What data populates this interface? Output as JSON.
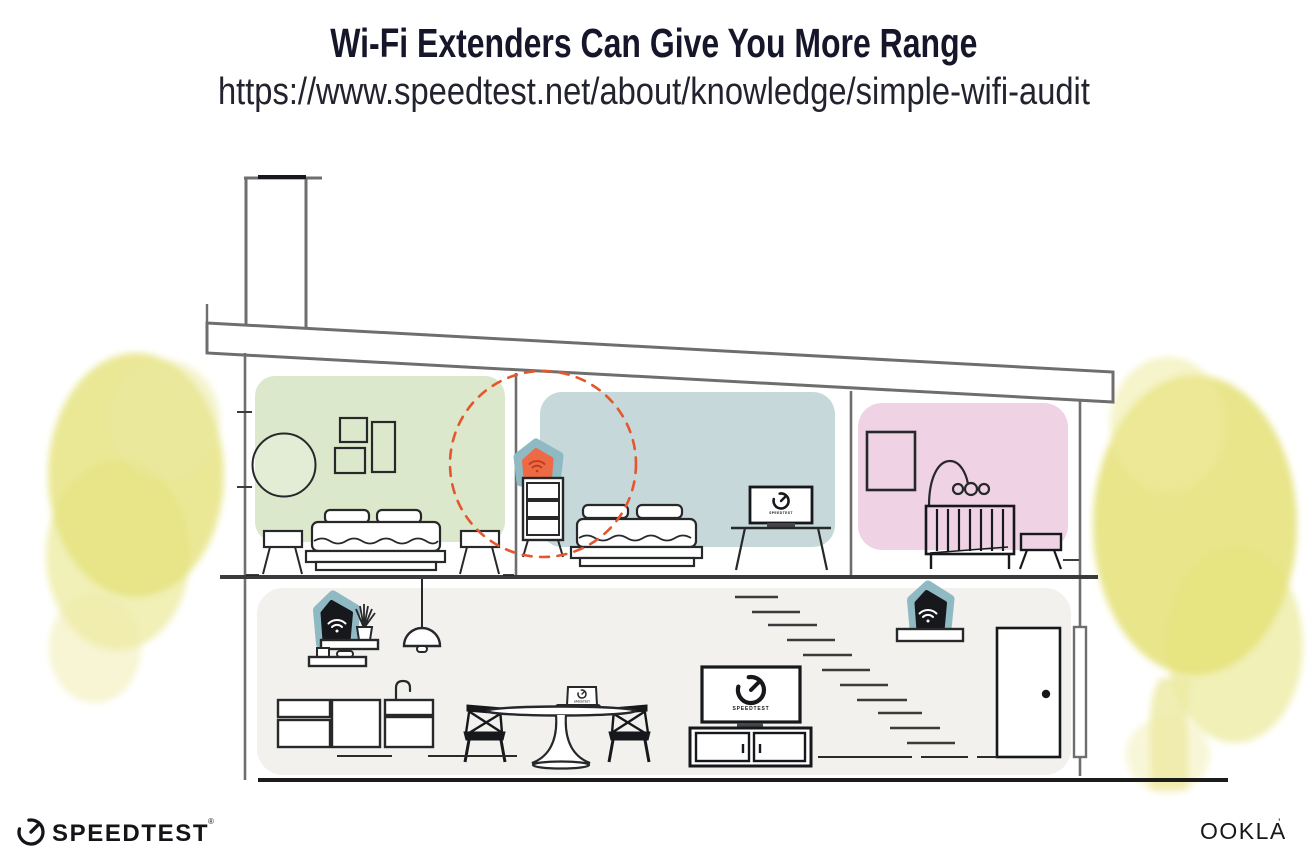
{
  "page": {
    "title": "Wi-Fi Extenders Can Give You More Range",
    "url": "https://www.speedtest.net/about/knowledge/simple-wifi-audit"
  },
  "branding": {
    "speedtest_wordmark": "SPEEDTEST",
    "speedtest_trademark": "®",
    "ookla_wordmark": "OOKLA",
    "ookla_trademark": "’"
  },
  "illustration": {
    "type": "house-cross-section",
    "rooms": [
      {
        "id": "bedroom-left",
        "wall_color": "#dce8cb"
      },
      {
        "id": "bedroom-middle",
        "wall_color": "#c6d8da"
      },
      {
        "id": "nursery",
        "wall_color": "#efd3e5"
      },
      {
        "id": "lower-floor",
        "wall_color": "#f2f1ee"
      }
    ],
    "devices": [
      {
        "id": "wifi-extender-upstairs",
        "marker_color": "#ee6a45",
        "halo_color": "#8fb9c3",
        "coverage_ring_color": "#e4572e"
      },
      {
        "id": "wifi-router-shelf",
        "marker_color": "#17181c",
        "halo_color": "#8fb9c3"
      },
      {
        "id": "wifi-extender-downstairs",
        "marker_color": "#17181c",
        "halo_color": "#8fb9c3"
      }
    ],
    "screens": [
      {
        "id": "bedroom-tv",
        "label": "SPEEDTEST"
      },
      {
        "id": "living-room-tv",
        "label": "SPEEDTEST"
      },
      {
        "id": "laptop",
        "label": "SPEEDTEST"
      }
    ],
    "foliage_color": "#e2df6d"
  }
}
